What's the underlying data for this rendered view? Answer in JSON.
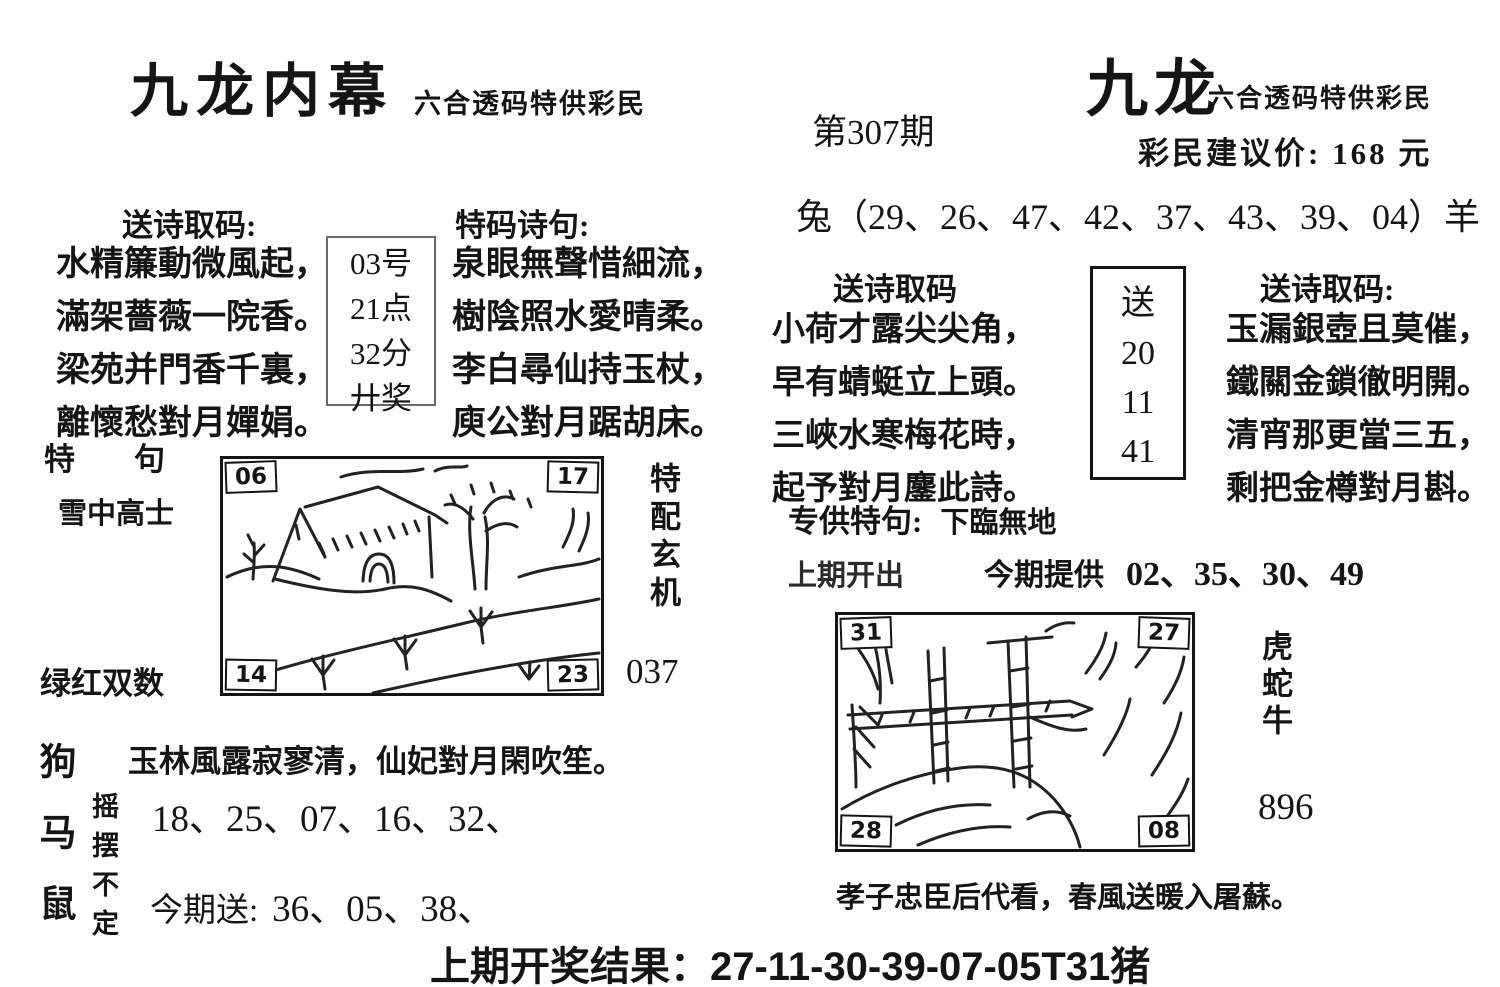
{
  "header": {
    "left_title": "九龙内幕",
    "left_subtitle": "六合透码特供彩民",
    "issue": "第307期",
    "right_title": "九龙",
    "right_subtitle": "六合透码特供彩民",
    "price_line": "彩民建议价: 168 元"
  },
  "zodiac_line": "兔（29、26、47、42、37、43、39、04）羊",
  "left_poem": {
    "heading": "送诗取码:",
    "lines": [
      "水精簾動微風起，",
      "滿架薔薇一院香。",
      "梁苑并門香千裏，",
      "離懷愁對月嬋娟。"
    ],
    "box": [
      "03号",
      "21点",
      "32分",
      "廾奖"
    ]
  },
  "tema_poem": {
    "heading": "特码诗句:",
    "lines": [
      "泉眼無聲惜細流，",
      "樹陰照水愛晴柔。",
      "李白尋仙持玉杖，",
      "庾公對月踞胡床。"
    ]
  },
  "mid_poem": {
    "heading": "送诗取码",
    "lines": [
      "小荷才露尖尖角，",
      "早有蜻蜓立上頭。",
      "三峽水寒梅花時，",
      "起予對月鏖此詩。"
    ]
  },
  "song_box": {
    "label": "送",
    "numbers": [
      "20",
      "11",
      "41"
    ]
  },
  "right_poem": {
    "heading": "送诗取码:",
    "lines": [
      "玉漏銀壺且莫催，",
      "鐵關金鎖徹明開。",
      "清宵那更當三五，",
      "剩把金樽對月斟。"
    ]
  },
  "special": {
    "label": "专供特句:",
    "value": "下臨無地"
  },
  "provide": {
    "prev_label": "上期开出",
    "now_label": "今期提供",
    "numbers": "02、35、30、49"
  },
  "left_picture": {
    "corners": {
      "tl": "06",
      "tr": "17",
      "bl": "14",
      "br": "23"
    },
    "label_special": "特　句",
    "label_phrase": "雪中高士",
    "label_colors": "绿红双数",
    "side_vertical": "特配玄机",
    "code": "037"
  },
  "bottom_left": {
    "zodiac_vertical": "狗马鼠",
    "sway_vertical": "摇摆不定",
    "poem_line": "玉林風露寂寥清，仙妃對月閑吹笙。",
    "numbers": "18、25、07、16、32、",
    "gift_label": "今期送:",
    "gift_numbers": "36、05、38、"
  },
  "right_picture": {
    "corners": {
      "tl": "31",
      "tr": "27",
      "bl": "28",
      "br": "08"
    },
    "side_vertical": "虎蛇牛",
    "code": "896",
    "caption": "孝子忠臣后代看，春風送暖入屠蘇。"
  },
  "footer": {
    "result_line": "上期开奖结果：27-11-30-39-07-05T31猪"
  }
}
